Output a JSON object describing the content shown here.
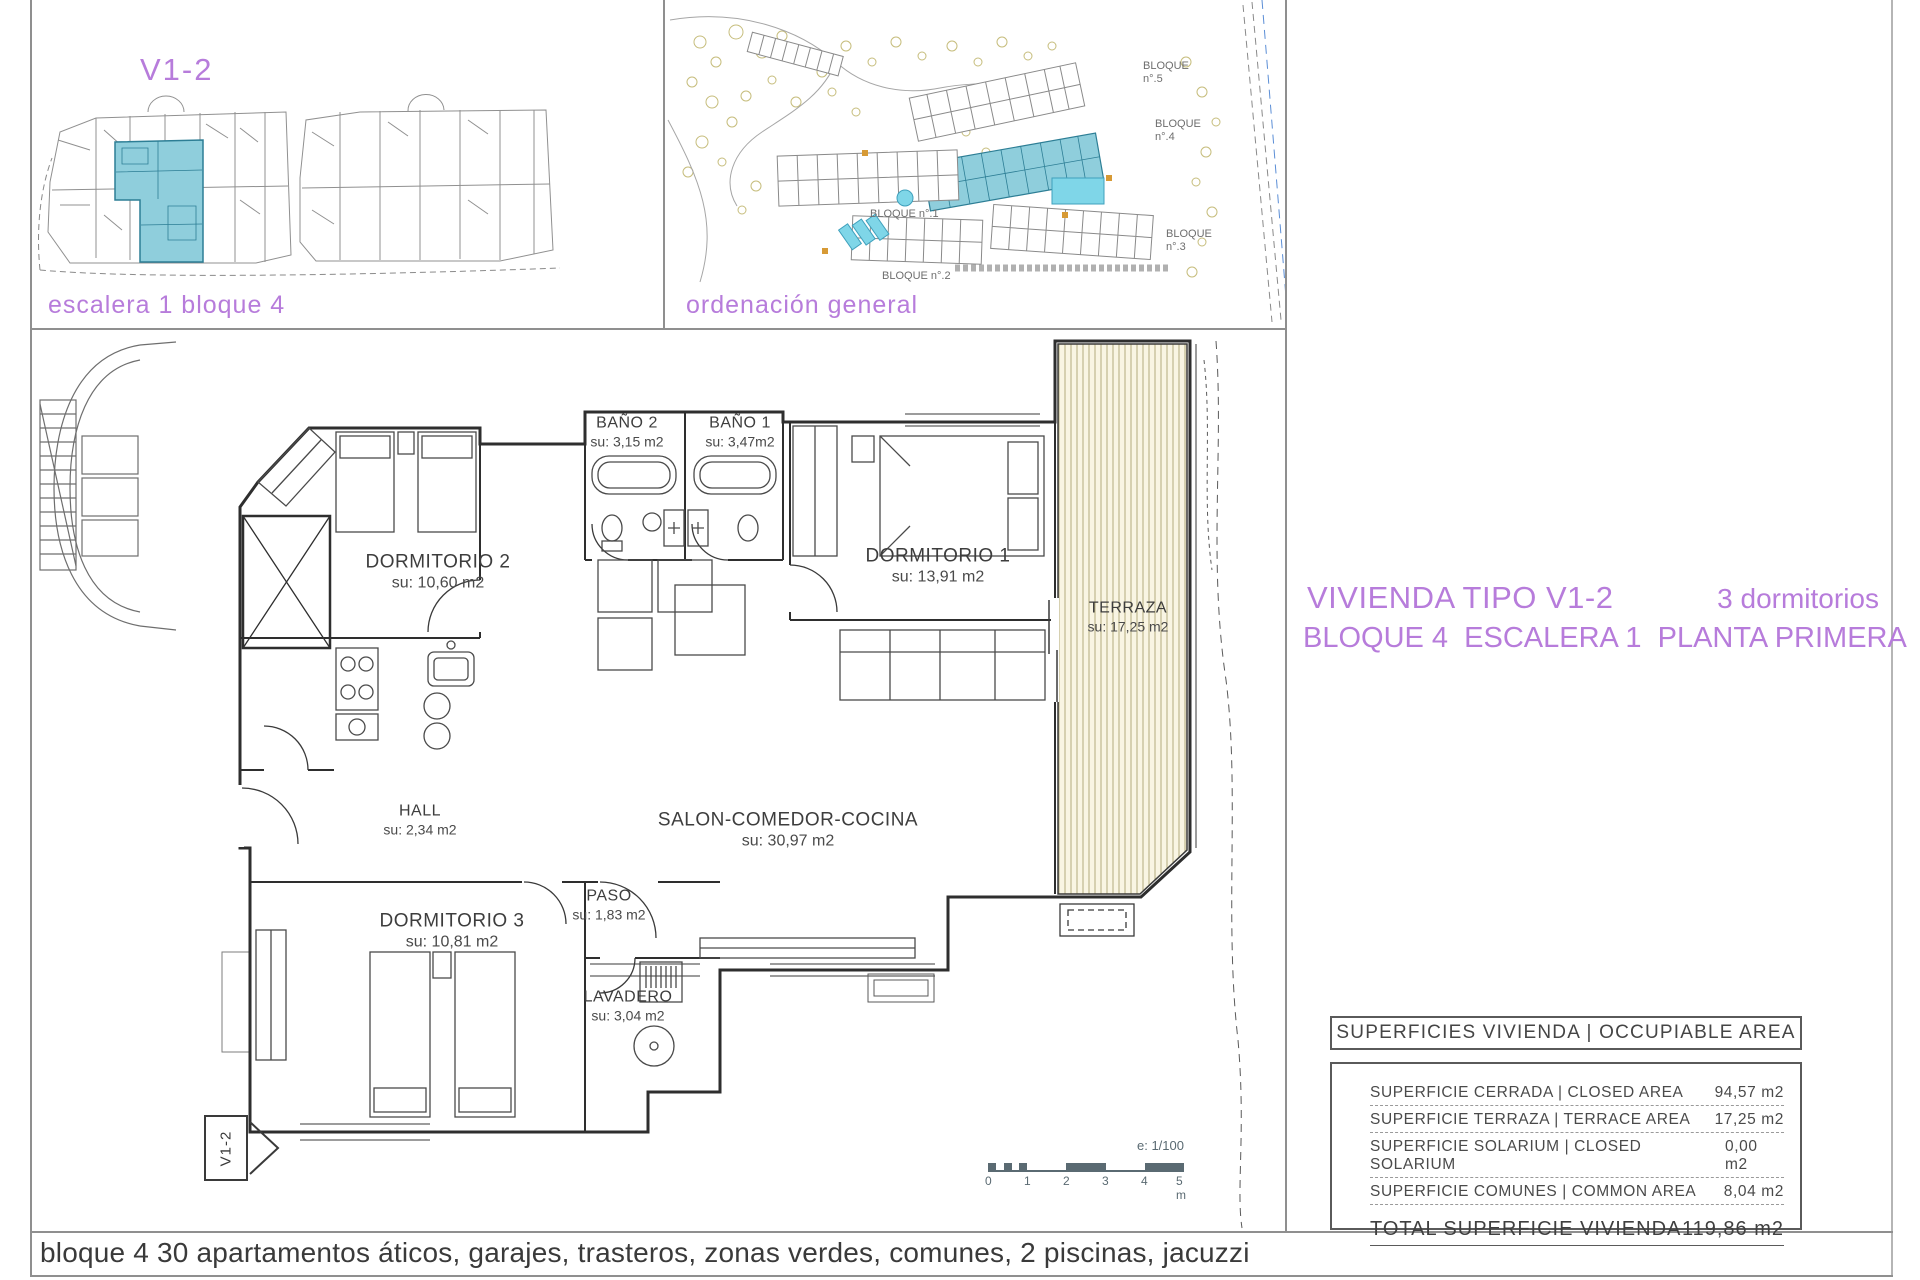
{
  "key_panel": {
    "title": "V1-2",
    "caption": "escalera 1 bloque 4"
  },
  "site_panel": {
    "caption": "ordenación general",
    "blocks": [
      {
        "label": "BLOQUE n°.5"
      },
      {
        "label": "BLOQUE n°.4"
      },
      {
        "label": "BLOQUE n°.1"
      },
      {
        "label": "BLOQUE n°.2"
      },
      {
        "label": "BLOQUE n°.3"
      }
    ]
  },
  "title_block": {
    "line1_left": "VIVIENDA TIPO V1-2",
    "line1_right": "3 dormitorios",
    "line2": "BLOQUE 4  ESCALERA 1  PLANTA PRIMERA"
  },
  "plan": {
    "entry_label": "V1-2",
    "rooms": [
      {
        "name": "DORMITORIO 2",
        "area": "su: 10,60 m2"
      },
      {
        "name": "BAÑO 2",
        "area": "su: 3,15 m2"
      },
      {
        "name": "BAÑO 1",
        "area": "su: 3,47m2"
      },
      {
        "name": "DORMITORIO 1",
        "area": "su: 13,91 m2"
      },
      {
        "name": "TERRAZA",
        "area": "su: 17,25 m2"
      },
      {
        "name": "HALL",
        "area": "su: 2,34 m2"
      },
      {
        "name": "SALON-COMEDOR-COCINA",
        "area": "su: 30,97 m2"
      },
      {
        "name": "PASO",
        "area": "su: 1,83 m2"
      },
      {
        "name": "DORMITORIO 3",
        "area": "su: 10,81 m2"
      },
      {
        "name": "LAVADERO",
        "area": "su: 3,04 m2"
      }
    ],
    "scale": {
      "ratio": "e: 1/100",
      "ticks": [
        "0",
        "1",
        "2",
        "3",
        "4",
        "5 m"
      ]
    }
  },
  "surface_table": {
    "header": "SUPERFICIES VIVIENDA | OCCUPIABLE AREA",
    "rows": [
      {
        "label": "SUPERFICIE CERRADA | CLOSED AREA",
        "value": "94,57 m2"
      },
      {
        "label": "SUPERFICIE TERRAZA | TERRACE AREA",
        "value": "17,25 m2"
      },
      {
        "label": "SUPERFICIE SOLARIUM | CLOSED SOLARIUM",
        "value": "0,00 m2"
      },
      {
        "label": "SUPERFICIE COMUNES | COMMON AREA",
        "value": "8,04 m2"
      }
    ],
    "total_label": "TOTAL SUPERFICIE VIVIENDA",
    "total_value": "119,86 m2"
  },
  "footer": "bloque 4 30 apartamentos áticos, garajes, trasteros, zonas verdes, comunes, 2 piscinas, jacuzzi",
  "colors": {
    "accent_purple": "#b77cdb",
    "highlight_teal": "#8fcedc",
    "pool_cyan": "#7fd6e8",
    "hatch_olive": "#b3ab7d",
    "scalebar_slate": "#5a6a72"
  }
}
